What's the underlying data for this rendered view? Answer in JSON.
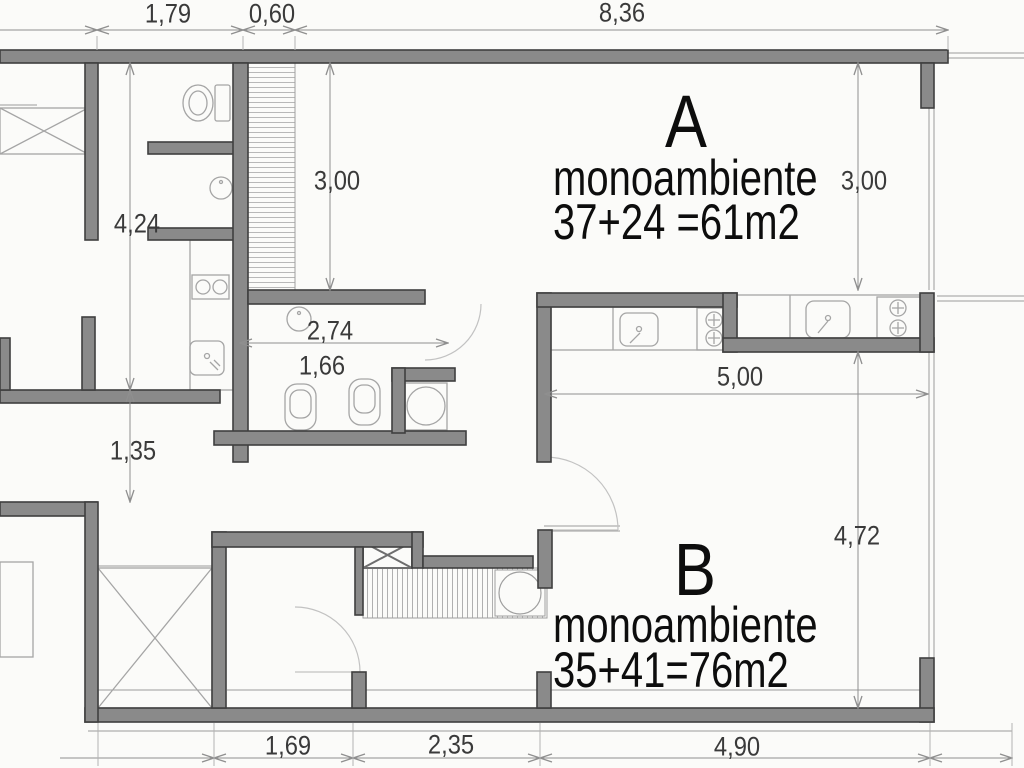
{
  "drawing_type": "architectural floor plan",
  "colors": {
    "background": "#fbfbf9",
    "wall_fill": "#8a8a8a",
    "wall_stroke": "#3f3f3f",
    "thin_line": "#9b9b9b",
    "dimension_line": "#8f8f8f",
    "dimension_text": "#3a3a3a",
    "unit_text": "#0d0d0d"
  },
  "dims": {
    "top_left": "1,79",
    "top_mid": "0,60",
    "top_right": "8,36",
    "left_upper": "4,24",
    "room_a_left": "3,00",
    "room_a_right": "3,00",
    "bath_width": "2,74",
    "bath_inner": "1,66",
    "left_lower": "1,35",
    "kitchen_width": "5,00",
    "room_b_right": "4,72",
    "bottom_left": "1,69",
    "bottom_mid": "2,35",
    "bottom_right": "4,90"
  },
  "units": {
    "a": {
      "letter": "A",
      "type": "monoambiente",
      "area": "37+24 =61m2"
    },
    "b": {
      "letter": "B",
      "type": "monoambiente",
      "area": "35+41=76m2"
    }
  }
}
